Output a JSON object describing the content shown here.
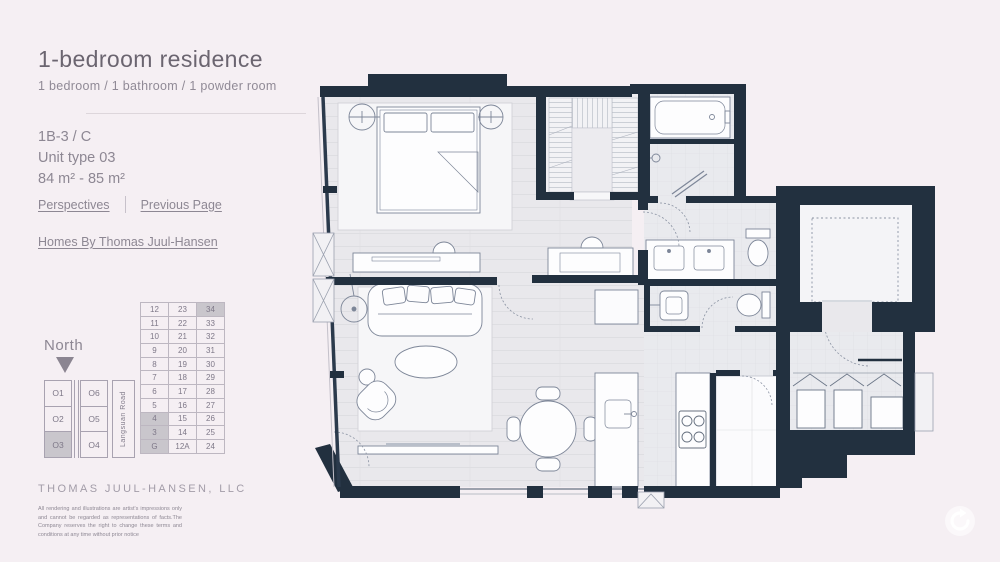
{
  "page": {
    "background_color": "#f5eff3"
  },
  "header": {
    "title": "1-bedroom residence",
    "subtitle": "1 bedroom / 1 bathroom / 1 powder room"
  },
  "unit_info": {
    "code": "1B-3 / C",
    "type_label": "Unit type 03",
    "area_label": "84 m² - 85 m²"
  },
  "nav": {
    "perspectives_label": "Perspectives",
    "previous_page_label": "Previous Page",
    "homes_link_label": "Homes By Thomas Juul-Hansen"
  },
  "compass": {
    "label": "North",
    "direction": "down"
  },
  "floor_table": {
    "rows": [
      [
        "12",
        "23",
        "34"
      ],
      [
        "11",
        "22",
        "33"
      ],
      [
        "10",
        "21",
        "32"
      ],
      [
        "9",
        "20",
        "31"
      ],
      [
        "8",
        "19",
        "30"
      ],
      [
        "7",
        "18",
        "29"
      ],
      [
        "6",
        "17",
        "28"
      ],
      [
        "5",
        "16",
        "27"
      ],
      [
        "4",
        "15",
        "26"
      ],
      [
        "3",
        "14",
        "25"
      ],
      [
        "G",
        "12A",
        "24"
      ]
    ],
    "highlighted_cells": [
      [
        0,
        2
      ],
      [
        8,
        0
      ],
      [
        9,
        0
      ],
      [
        10,
        0
      ]
    ]
  },
  "unit_map": {
    "rows": [
      [
        "O1",
        "O6"
      ],
      [
        "O2",
        "O5"
      ],
      [
        "O3",
        "O4"
      ]
    ],
    "selected_unit": "O3",
    "road_label": "Langsuan Road"
  },
  "footer": {
    "brand": "THOMAS JUUL-HANSEN, LLC",
    "disclaimer": "All rendering and illustrations are artist's impressions only and cannot be regarded as representations of facts.The Company reserves the right to change these terms and conditions at any time without prior notice"
  },
  "floor_plan": {
    "wall_color": "#22303f",
    "floor_color": "#e9e8ec",
    "highlight_color": "#c9c6cc"
  },
  "controls": {
    "rotate_button_icon": "rotate-arrow"
  }
}
